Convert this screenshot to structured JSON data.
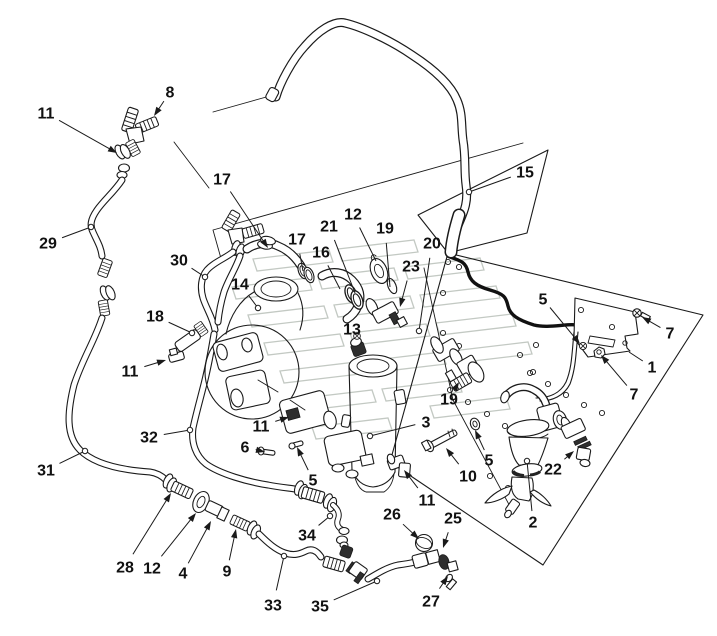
{
  "diagram": {
    "figure_type": "exploded parts diagram (hose and fuel-filter piping assembly)",
    "colors": {
      "background": "#ffffff",
      "line": "#1a1a1a",
      "watermark": "#c3c9c3"
    },
    "part_numbers_visible": [
      "1",
      "2",
      "3",
      "4",
      "5",
      "6",
      "7",
      "8",
      "9",
      "10",
      "11",
      "12",
      "13",
      "14",
      "15",
      "16",
      "17",
      "18",
      "19",
      "20",
      "21",
      "22",
      "23",
      "25",
      "26",
      "27",
      "28",
      "29",
      "30",
      "31",
      "32",
      "33",
      "34",
      "35"
    ],
    "callouts": [
      {
        "n": "8",
        "x": 170,
        "y": 92,
        "tx": 154,
        "ty": 116,
        "m": "a"
      },
      {
        "n": "11",
        "x": 46,
        "y": 113,
        "tx": 117,
        "ty": 153,
        "m": "a"
      },
      {
        "n": "29",
        "x": 48,
        "y": 243,
        "tx": 91,
        "ty": 227,
        "m": "d"
      },
      {
        "n": "17",
        "x": 222,
        "y": 179,
        "tx": 268,
        "ty": 248,
        "m": "a"
      },
      {
        "n": "30",
        "x": 179,
        "y": 260,
        "tx": 205,
        "ty": 277,
        "m": "d"
      },
      {
        "n": "14",
        "x": 240,
        "y": 284,
        "tx": 258,
        "ty": 308,
        "m": "d"
      },
      {
        "n": "18",
        "x": 155,
        "y": 316,
        "tx": 192,
        "ty": 333,
        "m": "d"
      },
      {
        "n": "17",
        "x": 297,
        "y": 239,
        "tx": 303,
        "ty": 271,
        "m": "p"
      },
      {
        "n": "16",
        "x": 321,
        "y": 252,
        "tx": 340,
        "ty": 289,
        "m": "p"
      },
      {
        "n": "21",
        "x": 329,
        "y": 226,
        "tx": 355,
        "ty": 293,
        "m": "p"
      },
      {
        "n": "12",
        "x": 353,
        "y": 214,
        "tx": 376,
        "ty": 261,
        "m": "p"
      },
      {
        "n": "19",
        "x": 385,
        "y": 228,
        "tx": 390,
        "ty": 287,
        "m": "p"
      },
      {
        "n": "20",
        "x": 432,
        "y": 243,
        "tx": 419,
        "ty": 331,
        "m": "d"
      },
      {
        "n": "23",
        "x": 411,
        "y": 266,
        "tx": 400,
        "ty": 307,
        "m": "a"
      },
      {
        "n": "15",
        "x": 525,
        "y": 172,
        "tx": 469,
        "ty": 192,
        "m": "d"
      },
      {
        "n": "5",
        "x": 543,
        "y": 299,
        "tx": 580,
        "ty": 344,
        "m": "a"
      },
      {
        "n": "7",
        "x": 670,
        "y": 333,
        "tx": 642,
        "ty": 317,
        "m": "a"
      },
      {
        "n": "1",
        "x": 652,
        "y": 367,
        "tx": 629,
        "ty": 352,
        "m": "p"
      },
      {
        "n": "7",
        "x": 634,
        "y": 394,
        "tx": 601,
        "ty": 355,
        "m": "a"
      },
      {
        "n": "13",
        "x": 352,
        "y": 329,
        "tx": 358,
        "ty": 342,
        "m": "p"
      },
      {
        "n": "11",
        "x": 130,
        "y": 371,
        "tx": 166,
        "ty": 360,
        "m": "a"
      },
      {
        "n": "32",
        "x": 149,
        "y": 437,
        "tx": 190,
        "ty": 430,
        "m": "d"
      },
      {
        "n": "31",
        "x": 46,
        "y": 470,
        "tx": 85,
        "ty": 451,
        "m": "d"
      },
      {
        "n": "11",
        "x": 261,
        "y": 426,
        "tx": 289,
        "ty": 417,
        "m": "a"
      },
      {
        "n": "6",
        "x": 245,
        "y": 447,
        "tx": 265,
        "ty": 452,
        "m": "a"
      },
      {
        "n": "5",
        "x": 313,
        "y": 480,
        "tx": 297,
        "ty": 447,
        "m": "a"
      },
      {
        "n": "3",
        "x": 426,
        "y": 422,
        "tx": 370,
        "ty": 436,
        "m": "d"
      },
      {
        "n": "19",
        "x": 449,
        "y": 399,
        "tx": 459,
        "ty": 382,
        "m": "a"
      },
      {
        "n": "10",
        "x": 468,
        "y": 476,
        "tx": 446,
        "ty": 448,
        "m": "a"
      },
      {
        "n": "5",
        "x": 489,
        "y": 460,
        "tx": 475,
        "ty": 430,
        "m": "a"
      },
      {
        "n": "22",
        "x": 553,
        "y": 469,
        "tx": 574,
        "ty": 451,
        "m": "a"
      },
      {
        "n": "2",
        "x": 533,
        "y": 522,
        "tx": 527,
        "ty": 461,
        "m": "d"
      },
      {
        "n": "11",
        "x": 427,
        "y": 500,
        "tx": 404,
        "ty": 470,
        "m": "a"
      },
      {
        "n": "26",
        "x": 392,
        "y": 514,
        "tx": 419,
        "ty": 539,
        "m": "a"
      },
      {
        "n": "25",
        "x": 453,
        "y": 518,
        "tx": 443,
        "ty": 548,
        "m": "a"
      },
      {
        "n": "27",
        "x": 431,
        "y": 601,
        "tx": 448,
        "ty": 576,
        "m": "a"
      },
      {
        "n": "28",
        "x": 125,
        "y": 567,
        "tx": 171,
        "ty": 493,
        "m": "a"
      },
      {
        "n": "12",
        "x": 152,
        "y": 568,
        "tx": 196,
        "ty": 513,
        "m": "a"
      },
      {
        "n": "4",
        "x": 183,
        "y": 573,
        "tx": 211,
        "ty": 521,
        "m": "a"
      },
      {
        "n": "9",
        "x": 227,
        "y": 571,
        "tx": 236,
        "ty": 529,
        "m": "a"
      },
      {
        "n": "34",
        "x": 307,
        "y": 535,
        "tx": 330,
        "ty": 516,
        "m": "d"
      },
      {
        "n": "33",
        "x": 273,
        "y": 605,
        "tx": 284,
        "ty": 556,
        "m": "d"
      },
      {
        "n": "35",
        "x": 320,
        "y": 606,
        "tx": 377,
        "ty": 581,
        "m": "d"
      }
    ]
  }
}
